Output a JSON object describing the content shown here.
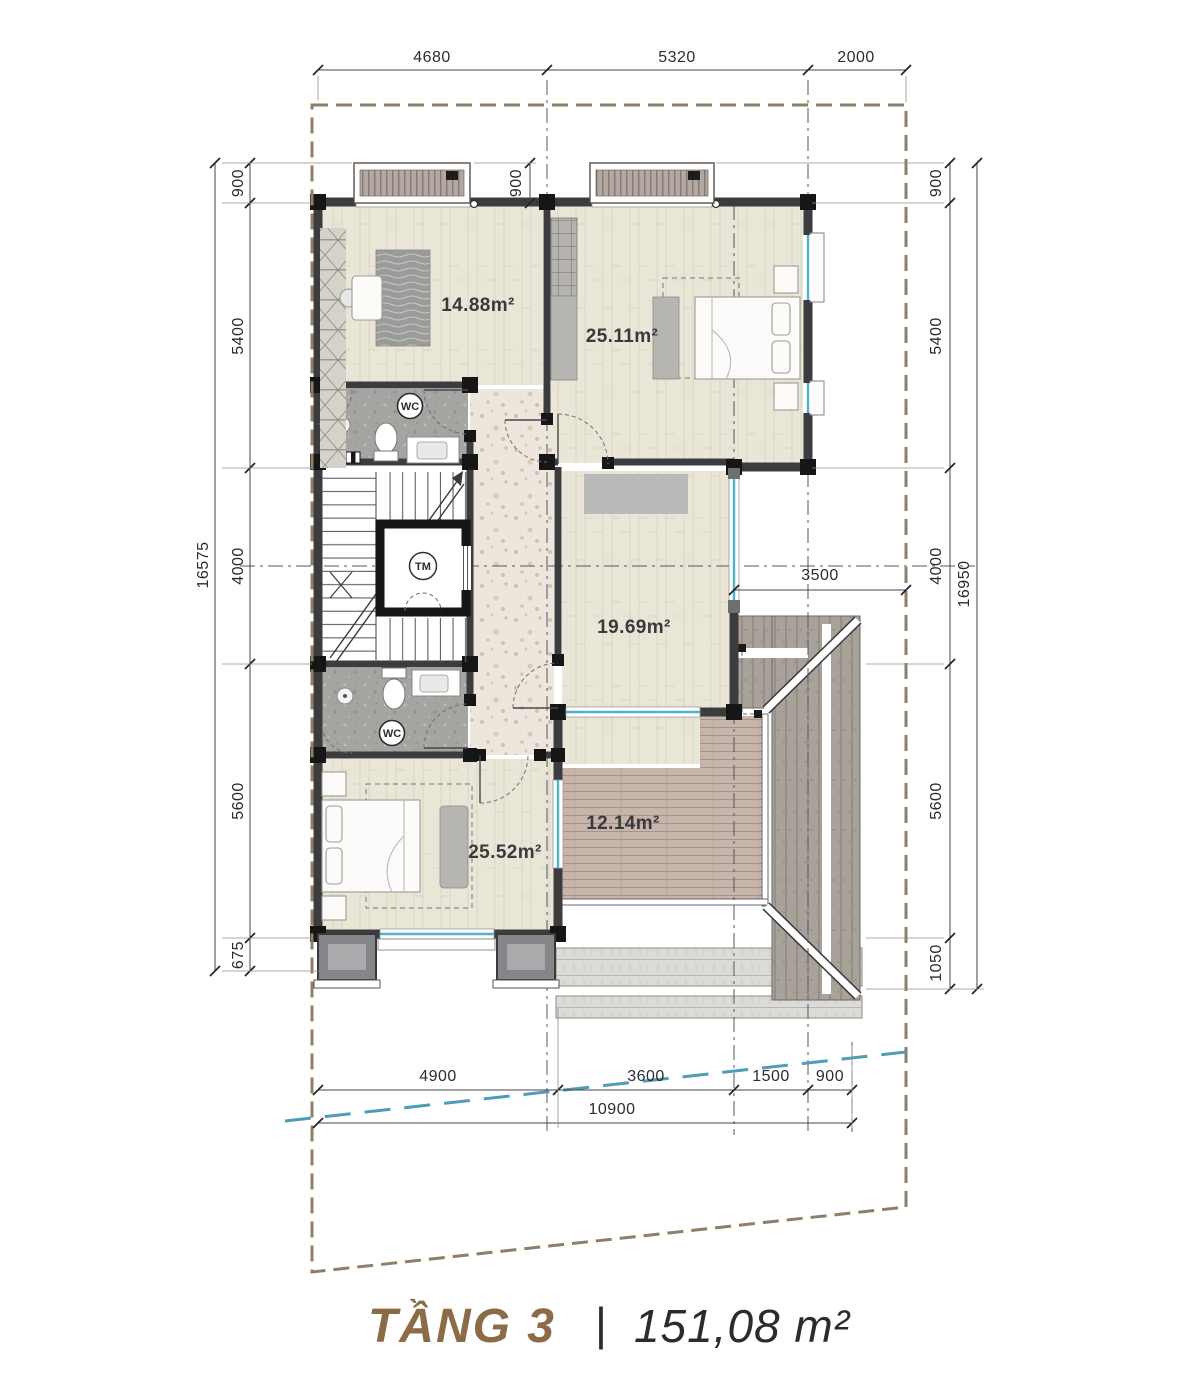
{
  "title": {
    "floor": "TẦNG 3",
    "separator": "|",
    "area": "151,08 m²"
  },
  "rooms": {
    "study": "14.88m²",
    "master_bedroom": "25.11m²",
    "family_room": "19.69m²",
    "bedroom2": "25.52m²",
    "terrace": "12.14m²"
  },
  "labels": {
    "wc_top": "WC",
    "wc_bottom": "WC",
    "elevator": "TM"
  },
  "dims": {
    "top": [
      "4680",
      "5320",
      "2000"
    ],
    "canopy": "900",
    "left": [
      "900",
      "5400",
      "4000",
      "5600",
      "675"
    ],
    "left_total": "16575",
    "right": [
      "900",
      "5400",
      "4000",
      "5600",
      "1050"
    ],
    "right_total": "16950",
    "mid": "3500",
    "bottom": [
      "4900",
      "3600",
      "1500",
      "900"
    ],
    "bottom_total": "10900"
  },
  "colors": {
    "lot_boundary": "#8f7e68",
    "setback_line": "#4f9cb8",
    "glass": "#53b3c6",
    "accent": "#8c6c46",
    "ink": "#2c2c2e"
  }
}
